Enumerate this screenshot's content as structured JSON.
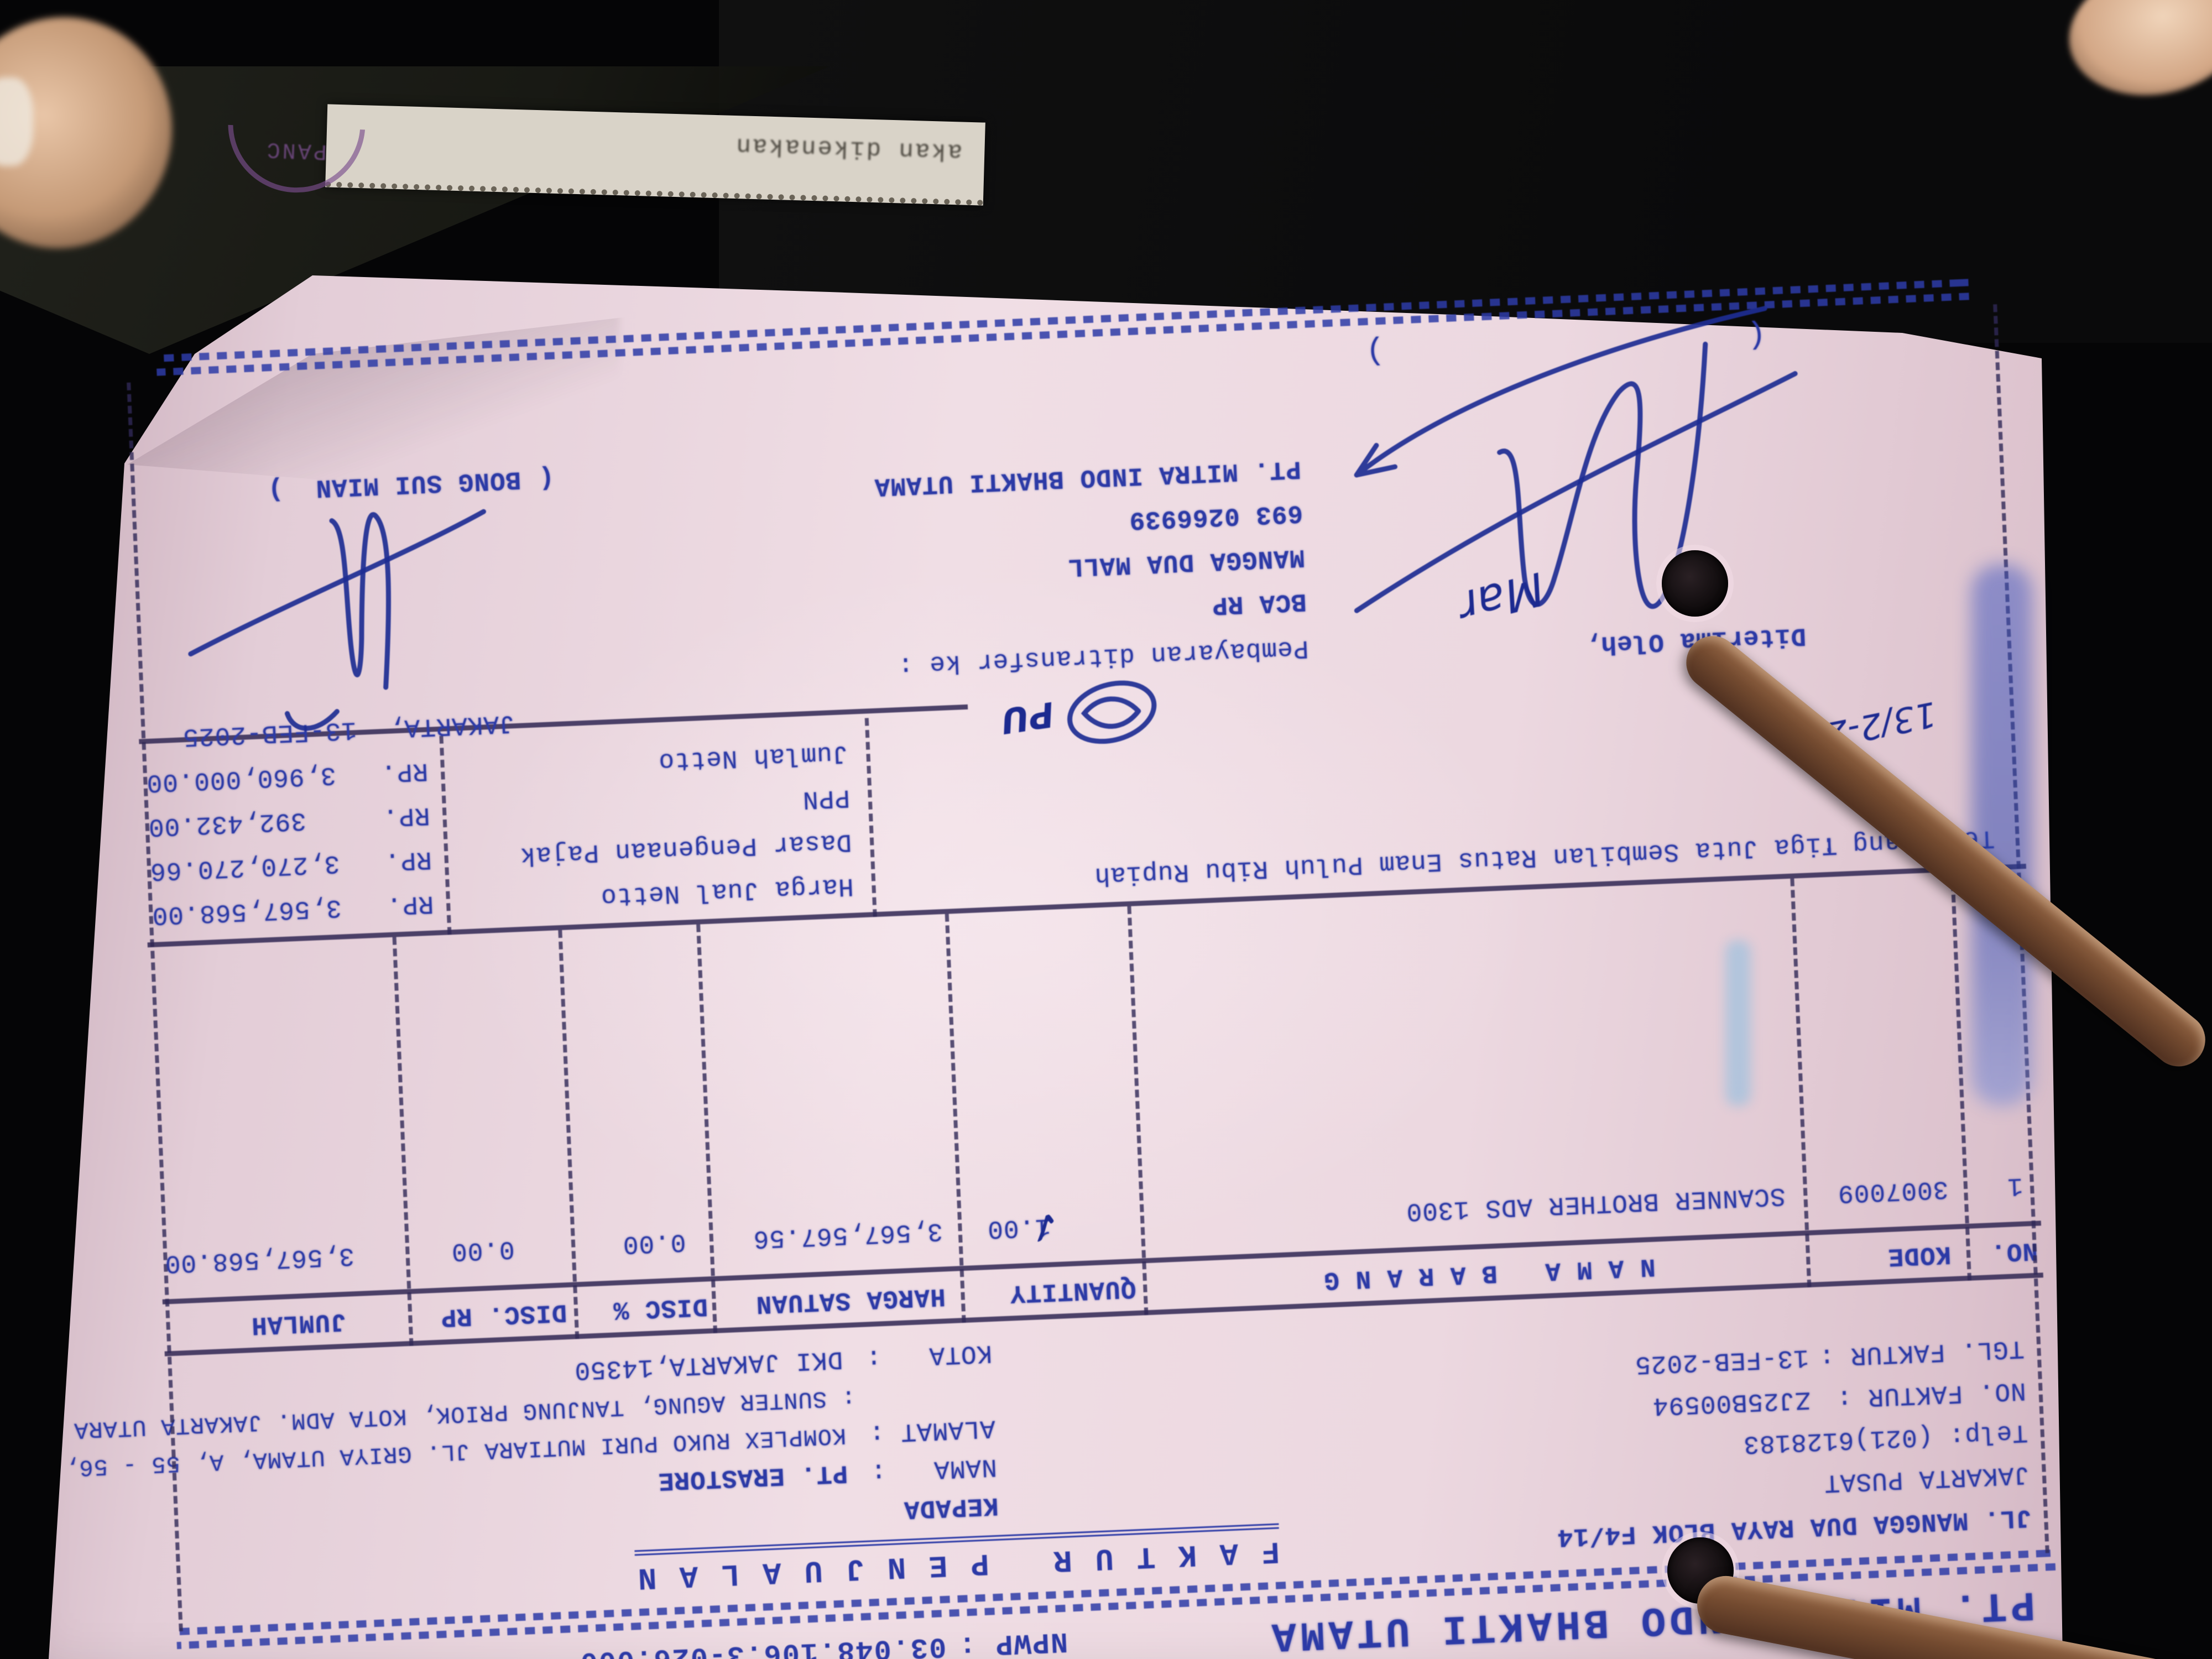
{
  "scene": {
    "strip_text": "akan dikenakan",
    "stamp_text": "PANC"
  },
  "invoice": {
    "company": "PT. MITRA INDO BHAKTI UTAMA",
    "npwp_label": "NPWP :",
    "npwp": "03.048.106.3-026.000",
    "hal_label": "HAL :",
    "hal": "1",
    "title": "F A K T U R   P E N J U A L A N",
    "address_line1": "JL. MANGGA DUA RAYA BLOK F4/14",
    "address_line2": "JAKARTA PUSAT",
    "phone": "Telp: (021)6128183",
    "no_faktur_label": "NO. FAKTUR :",
    "no_faktur": "ZJ25B00594",
    "tgl_faktur_label": "TGL. FAKTUR :",
    "tgl_faktur": "13-FEB-2025",
    "kepada_label": "KEPADA",
    "nama_label": "NAMA   :",
    "nama_value": "PT. ERASTORE",
    "alamat_label": "ALAMAT :",
    "alamat_value1": "KOMPLEX RUKO PURI MUTIARA JL. GRIYA UTAMA, A, 55 - 56,",
    "alamat_value2": ": SUNTER AGUNG, TANJUNG PRIOK, KOTA ADM. JAKARTA UTARA",
    "kota_label": "KOTA   :",
    "kota_value": "DKI JAKARTA,14350",
    "table": {
      "headers": [
        "NO.",
        "KODE",
        "N A M A   B A R A N G",
        "QUANTITY",
        "HARGA SATUAN",
        "DISC %",
        "DISC. RP",
        "JUMLAH"
      ],
      "row": {
        "no": "1",
        "kode": "3007009",
        "nama": "SCANNER BROTHER ADS 1300",
        "qty": "1.00",
        "harga": "3,567,567.56",
        "disc_pct": "0.00",
        "disc_rp": "0.00",
        "jumlah": "3,567,568.00"
      }
    },
    "terbilang_label": "Terbilang :",
    "terbilang_text": "Tiga Juta Sembilan Ratus Enam Puluh Ribu Rupiah",
    "totals": [
      {
        "label": "Harga Jual Netto",
        "cur": "RP.",
        "value": "3,567,568.00"
      },
      {
        "label": "Dasar Pengenaan Pajak",
        "cur": "RP.",
        "value": "3,270,270.66"
      },
      {
        "label": "PPN",
        "cur": "RP.",
        "value": "392,432.00"
      },
      {
        "label": "Jumlah Netto",
        "cur": "RP.",
        "value": "3,960,000.00"
      }
    ],
    "payment": {
      "heading": "Pembayaran ditransfer ke :",
      "lines": [
        "BCA RP",
        "MANGGA DUA MALL",
        "693 0266939",
        "PT. MITRA INDO BHAKTI UTAMA"
      ]
    },
    "signing": {
      "received_label": "Diterima Oleh,",
      "city_date": "JAKARTA,  13-FEB-2025",
      "signer_name": "BONG SUI MIAN",
      "bracket_open": "(",
      "bracket_close": ")"
    },
    "handwriting": {
      "date": "13/2-25",
      "check": "✓",
      "pu": "PU",
      "initial": "Mar"
    }
  }
}
